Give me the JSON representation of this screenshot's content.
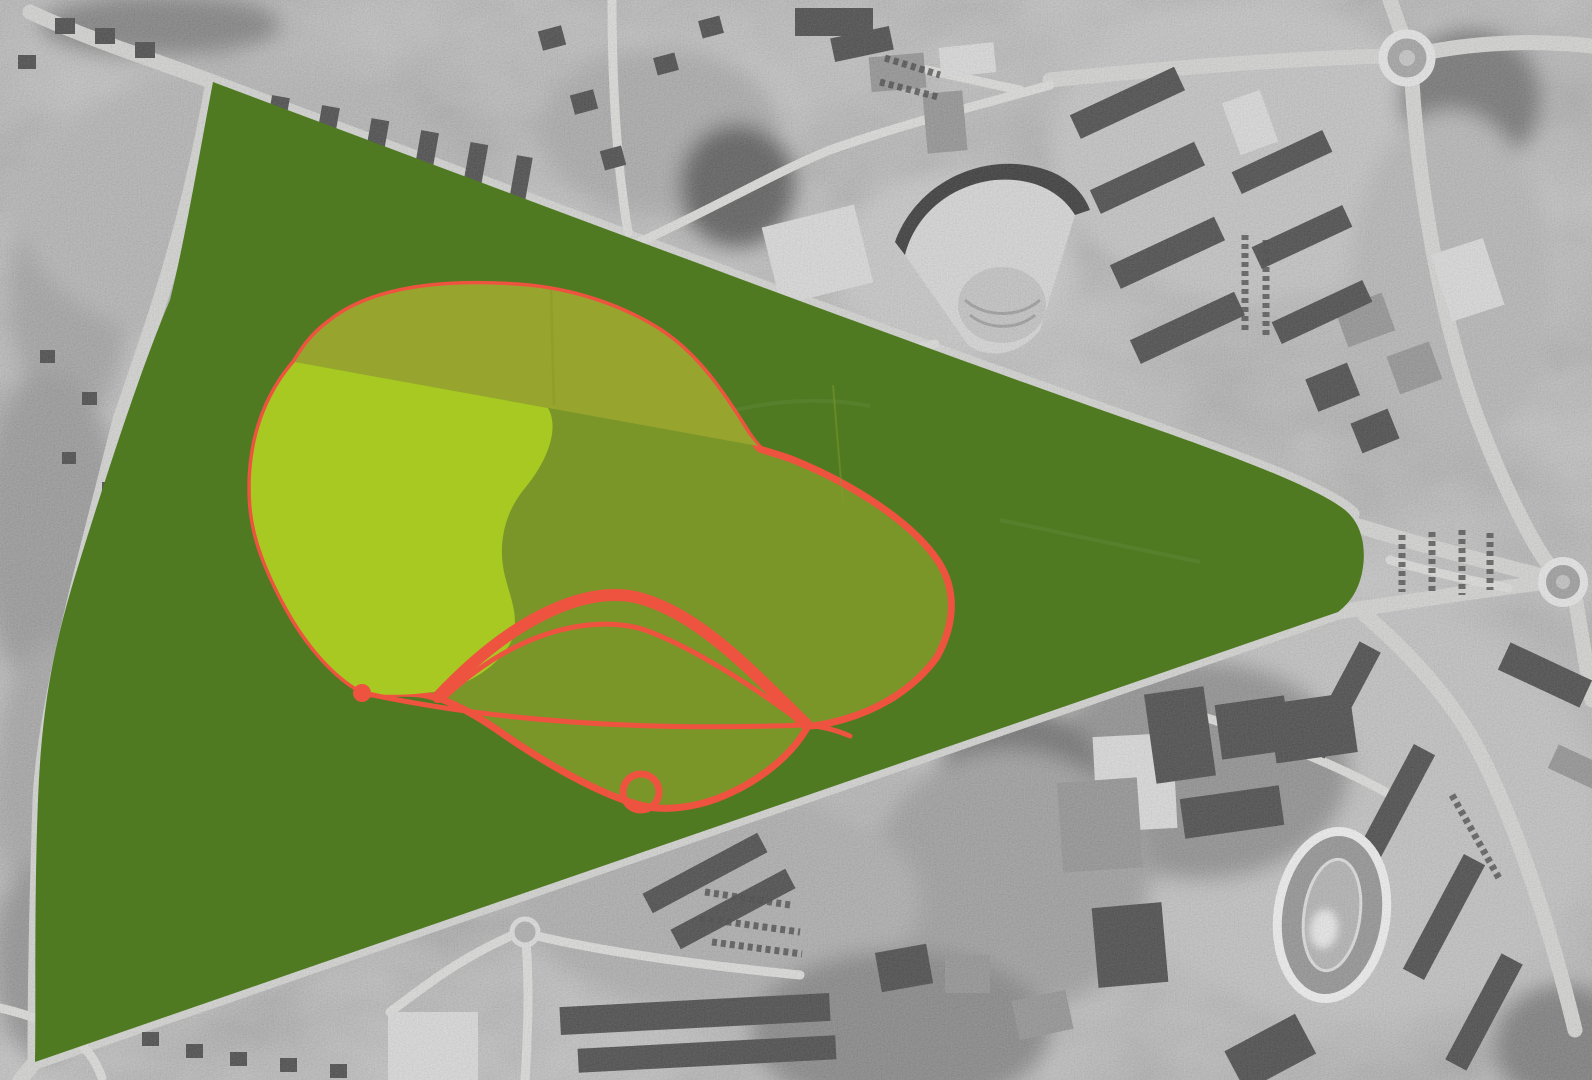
{
  "meta": {
    "kind": "aerial-photo-with-park-design-overlay",
    "width": 1592,
    "height": 1080
  },
  "overlay": {
    "park_fill": "#4f7a22",
    "blob_fill": "#7a9628",
    "blob_top_band_fill": "#97a52e",
    "lawn_fill": "#a7c922",
    "route_color": "#ee5340"
  },
  "photo": {
    "base": "#b6b6b6",
    "road": "#d3d3d1",
    "road_minor": "#dcdcda",
    "roof_dark": "#404040",
    "roof_mid": "#8f8f8f",
    "roof_light": "#dadada",
    "track_color": "#f0f0f0",
    "car_color": "#3a3a3a"
  }
}
